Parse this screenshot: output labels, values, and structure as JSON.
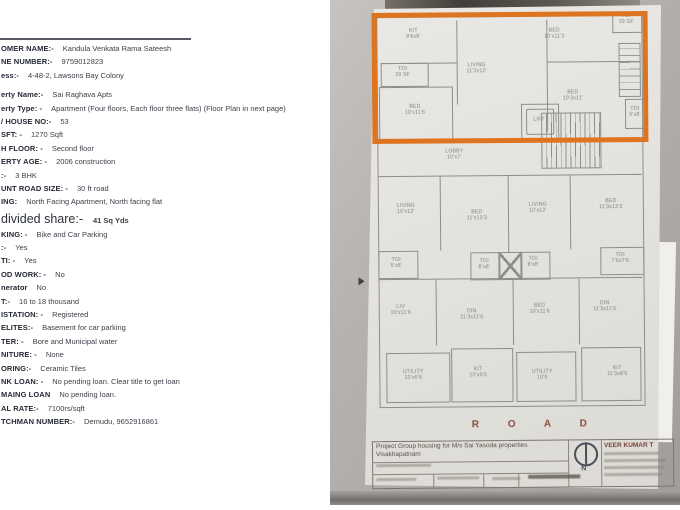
{
  "document": {
    "rows_top": [
      {
        "label": "OMER NAME:-",
        "value": "Kandula Venkata Rama Sateesh"
      },
      {
        "label": "NE NUMBER:-",
        "value": "9759012823"
      },
      {
        "label": "ess:-",
        "value": "4-48-2, Lawsons Bay Colony"
      },
      {
        "label": "erty Name:-",
        "value": "Sai Raghava Apts"
      },
      {
        "label": "erty Type: -",
        "value": "Apartment (Four floors, Each floor three flats) (Floor Plan in next page)"
      },
      {
        "label": "/ HOUSE NO:-",
        "value": "53"
      },
      {
        "label": "SFT: -",
        "value": "1270 Sqft"
      },
      {
        "label": "H FLOOR: -",
        "value": "Second floor"
      },
      {
        "label": "ERTY AGE: -",
        "value": "2006 construction"
      },
      {
        "label": ":-",
        "value": "3 BHK"
      },
      {
        "label": "UNT ROAD SIZE: -",
        "value": "30 ft road"
      },
      {
        "label": "ING:",
        "value": "North Facing Apartment, North facing flat"
      }
    ],
    "share_row": {
      "label": "divided share:-",
      "value": "41 Sq Yds"
    },
    "rows_bottom": [
      {
        "label": "KING: -",
        "value": "Bike and Car Parking"
      },
      {
        "label": ":-",
        "value": "Yes"
      },
      {
        "label": "TI: -",
        "value": "Yes"
      },
      {
        "label": "OD WORK: -",
        "value": "No"
      },
      {
        "label": "nerator",
        "value": "No"
      },
      {
        "label": "T:-",
        "value": "16 to 18 thousand"
      },
      {
        "label": "ISTATION: -",
        "value": "Registered"
      },
      {
        "label": "ELITES:-",
        "value": "Basement for car parking"
      },
      {
        "label": "TER: -",
        "value": "Bore and Municipal water"
      },
      {
        "label": "NITURE: -",
        "value": "None"
      },
      {
        "label": "ORING:-",
        "value": "Ceramic Tiles"
      },
      {
        "label": "NK LOAN: -",
        "value": "No pending loan. Clear title to get loan"
      },
      {
        "label": "MAING LOAN",
        "value": "No pending loan."
      },
      {
        "label": "AL RATE:-",
        "value": "7100rs/sqft"
      },
      {
        "label": "TCHMAN NUMBER:-",
        "value": "Demudu, 9652916861"
      }
    ]
  },
  "floorplan": {
    "highlight_color": "#dc7420",
    "road_label": "R O A D",
    "rooms": [
      {
        "label": "KIT",
        "dims": "9'6x8'"
      },
      {
        "label": "TOI",
        "dims": "29 SF"
      },
      {
        "label": "LIVING",
        "dims": "11'3x12'"
      },
      {
        "label": "BED",
        "dims": "10'x11'3"
      },
      {
        "label": "TOI",
        "dims": "29 SF"
      },
      {
        "label": "BED",
        "dims": "10'3x11'"
      },
      {
        "label": "TOI",
        "dims": "5'x8'"
      },
      {
        "label": "BED",
        "dims": "10'x11'6"
      },
      {
        "label": "LIFT",
        "dims": ""
      },
      {
        "label": "LOBBY",
        "dims": "10'x7'"
      },
      {
        "label": "LIVING",
        "dims": "10'x12'"
      },
      {
        "label": "BED",
        "dims": "11'x13'3"
      },
      {
        "label": "LIVING",
        "dims": "10'x12'"
      },
      {
        "label": "BED",
        "dims": "11'3x13'3"
      },
      {
        "label": "TOI",
        "dims": "5'x8'"
      },
      {
        "label": "TOI",
        "dims": "8'x8'"
      },
      {
        "label": "TOI",
        "dims": "8'x8'"
      },
      {
        "label": "TOI",
        "dims": "7'6x7'6"
      },
      {
        "label": "LIV",
        "dims": "10'x11'6"
      },
      {
        "label": "DIN",
        "dims": "11'3x11'6"
      },
      {
        "label": "BED",
        "dims": "10'x11'6"
      },
      {
        "label": "DIN",
        "dims": "11'3x11'6"
      },
      {
        "label": "UTILITY",
        "dims": "10'x6'6"
      },
      {
        "label": "KIT",
        "dims": "10'x9'6"
      },
      {
        "label": "UTILITY",
        "dims": "10'6"
      },
      {
        "label": "KIT",
        "dims": "11'3x9'6"
      }
    ],
    "title_block": {
      "project_line": "Project  Group housing for M/s Sai Yasoda properties",
      "city_line": "Visakhapatnam",
      "architect_name": "VEER KUMAR T",
      "north_letter": "N"
    }
  }
}
